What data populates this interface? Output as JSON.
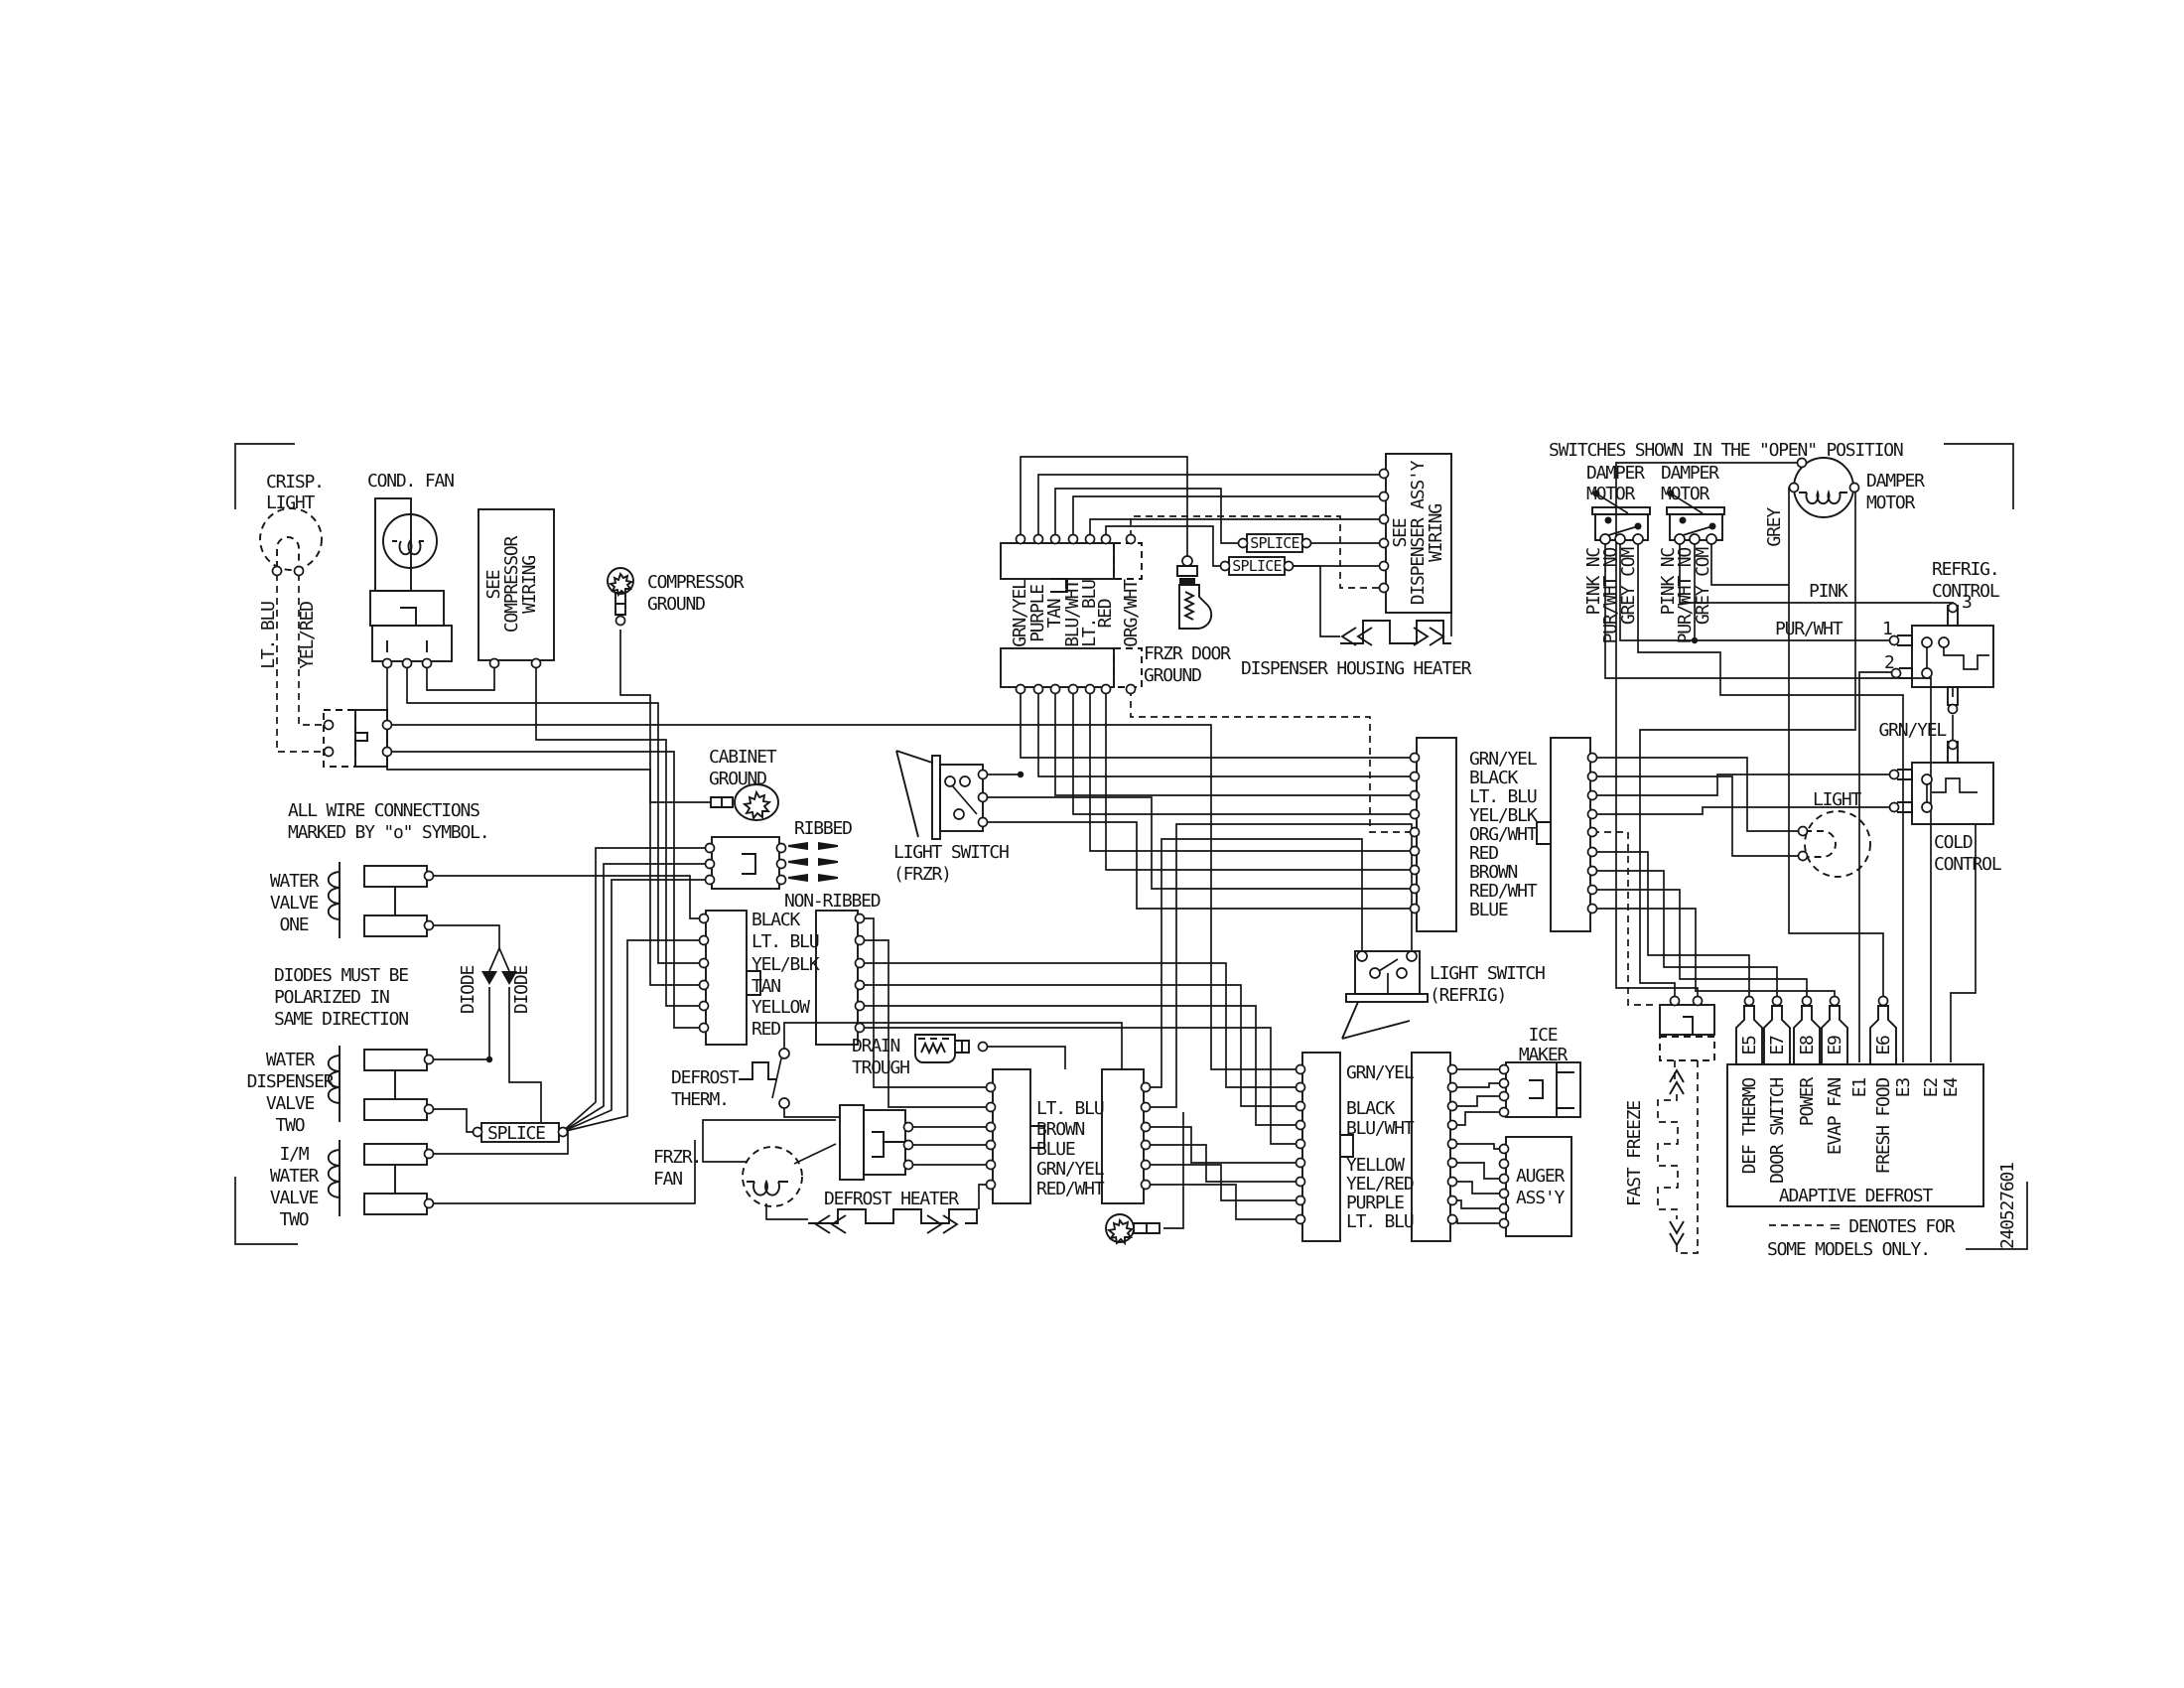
{
  "diagram": {
    "part_number": "240527601",
    "notes": {
      "switches": "SWITCHES SHOWN IN THE \"OPEN\" POSITION",
      "connections": [
        "ALL WIRE CONNECTIONS",
        "MARKED BY \"o\" SYMBOL."
      ],
      "diodes": [
        "DIODES MUST BE",
        "POLARIZED IN",
        "SAME DIRECTION"
      ],
      "models": [
        "= DENOTES FOR",
        "SOME MODELS ONLY."
      ]
    },
    "components": {
      "crisp_light": {
        "label": [
          "CRISP.",
          "LIGHT"
        ],
        "wires": [
          "LT. BLU",
          "YEL/RED"
        ]
      },
      "cond_fan": {
        "label": "COND. FAN"
      },
      "compressor_box": {
        "label": [
          "SEE",
          "COMPRESSOR",
          "WIRING"
        ]
      },
      "compressor_ground": {
        "label": [
          "COMPRESSOR",
          "GROUND"
        ]
      },
      "cabinet_ground": {
        "label": [
          "CABINET",
          "GROUND"
        ]
      },
      "water_valve_one": {
        "label": [
          "WATER",
          "VALVE",
          "ONE"
        ]
      },
      "diode_left": "DIODE",
      "diode_right": "DIODE",
      "water_dispenser_valve_two": {
        "label": [
          "WATER",
          "DISPENSER",
          "VALVE",
          "TWO"
        ]
      },
      "im_water_valve_two": {
        "label": [
          "I/M",
          "WATER",
          "VALVE",
          "TWO"
        ]
      },
      "splice_left": "SPLICE",
      "ribbed": "RIBBED",
      "non_ribbed": "NON-RIBBED",
      "conn_mid_upper": {
        "wires": [
          "BLACK",
          "LT. BLU",
          "YEL/BLK",
          "TAN",
          "YELLOW",
          "RED"
        ]
      },
      "drain_trough": {
        "label": [
          "DRAIN",
          "TROUGH"
        ]
      },
      "defrost_therm": {
        "label": [
          "DEFROST",
          "THERM."
        ]
      },
      "frzr_fan": {
        "label": [
          "FRZR.",
          "FAN"
        ]
      },
      "defrost_heater": {
        "label": "DEFROST HEATER"
      },
      "conn_mid_lower": {
        "wires": [
          "LT. BLU",
          "BROWN",
          "BLUE",
          "GRN/YEL",
          "RED/WHT"
        ]
      },
      "light_switch_frzr": {
        "label": [
          "LIGHT SWITCH",
          "(FRZR)"
        ]
      },
      "conn_top": {
        "wires": [
          "GRN/YEL",
          "PURPLE",
          "TAN",
          "BLU/WHT",
          "LT. BLU",
          "RED",
          "ORG/WHT"
        ]
      },
      "frzr_door_ground": {
        "label": [
          "FRZR DOOR",
          "GROUND"
        ]
      },
      "splice_top_1": "SPLICE",
      "splice_top_2": "SPLICE",
      "dispenser_box": {
        "label": [
          "SEE",
          "DISPENSER ASS'Y",
          "WIRING"
        ]
      },
      "dispenser_housing_heater": {
        "label": "DISPENSER HOUSING HEATER"
      },
      "conn_right": {
        "wires": [
          "GRN/YEL",
          "BLACK",
          "LT. BLU",
          "YEL/BLK",
          "ORG/WHT",
          "RED",
          "BROWN",
          "RED/WHT",
          "BLUE"
        ]
      },
      "light_switch_refrig": {
        "label": [
          "LIGHT SWITCH",
          "(REFRIG)"
        ]
      },
      "conn_bottom_right": {
        "wires": [
          "GRN/YEL",
          "BLACK",
          "BLU/WHT",
          "YELLOW",
          "YEL/RED",
          "PURPLE",
          "LT. BLU"
        ]
      },
      "ice_maker": {
        "label": [
          "ICE",
          "MAKER"
        ]
      },
      "auger_assy": {
        "label": [
          "AUGER",
          "ASS'Y"
        ]
      },
      "damper_motor_1": {
        "label": [
          "DAMPER",
          "MOTOR"
        ],
        "wires": [
          "PINK NC",
          "PUR/WHT NO",
          "GREY COM"
        ]
      },
      "damper_motor_2": {
        "label": [
          "DAMPER",
          "MOTOR"
        ],
        "wires": [
          "PINK NC",
          "PUR/WHT NO",
          "GREY COM"
        ]
      },
      "damper_motor_3": {
        "label": [
          "DAMPER",
          "MOTOR"
        ],
        "wire": "GREY"
      },
      "wire_pink": "PINK",
      "wire_pur_wht": "PUR/WHT",
      "wire_grn_yel": "GRN/YEL",
      "refrig_control": {
        "label": [
          "REFRIG.",
          "CONTROL"
        ],
        "terminals": [
          "1",
          "2",
          "3"
        ]
      },
      "light_refrig": {
        "label": "LIGHT"
      },
      "cold_control": {
        "label": [
          "COLD",
          "CONTROL"
        ]
      },
      "fast_freeze": {
        "label": "FAST FREEZE"
      },
      "adaptive_defrost": {
        "label": "ADAPTIVE DEFROST",
        "terminals": [
          "E5",
          "E7",
          "E8",
          "E9",
          "E6"
        ],
        "pins": [
          "DEF THERMO",
          "DOOR SWITCH",
          "POWER",
          "EVAP FAN",
          "E1",
          "FRESH FOOD",
          "E3",
          "E2",
          "E4"
        ]
      }
    }
  }
}
